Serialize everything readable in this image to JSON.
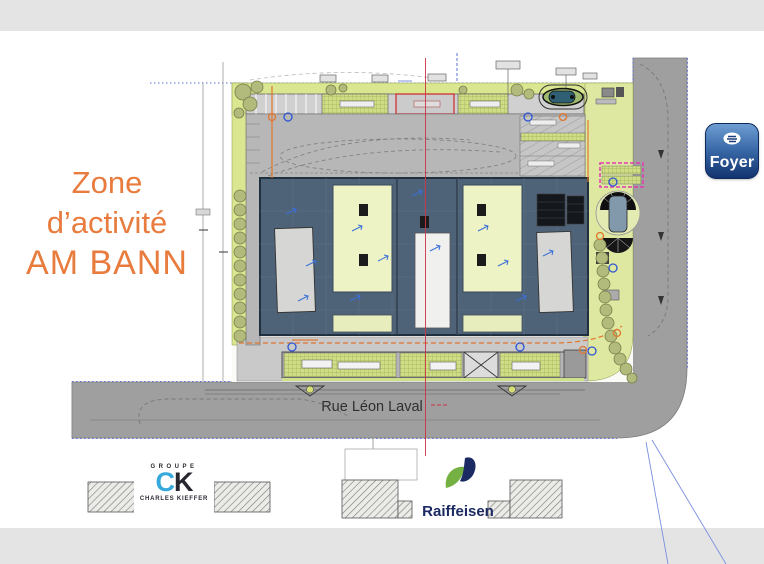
{
  "title": {
    "line1": "Zone",
    "line2": "d’activité",
    "line3": "AM BANN",
    "color": "#e87c3e"
  },
  "plan": {
    "street_label": "Rue Léon Laval",
    "colors": {
      "building_roof": "#4f6378",
      "hall_pale": "#eef3c6",
      "green_strip": "#dbe690",
      "road_gray": "#9f9f9f",
      "boundary_blue": "#5a6fd8",
      "construction_limit_orange": "#e0762e",
      "axis_red": "#cc3344",
      "survey_magenta": "#e23bb0"
    }
  },
  "logos": {
    "foyer": {
      "label": "Foyer",
      "bg_top": "#6f9cd1",
      "bg_bottom": "#12336f"
    },
    "ck": {
      "groupe": "GROUPE",
      "c": "C",
      "k": "K",
      "name": "CHARLES KIEFFER",
      "c_color": "#35a8dc"
    },
    "raiffeisen": {
      "label": "Raiffeisen",
      "green": "#74b042",
      "navy": "#1b2a63"
    }
  }
}
